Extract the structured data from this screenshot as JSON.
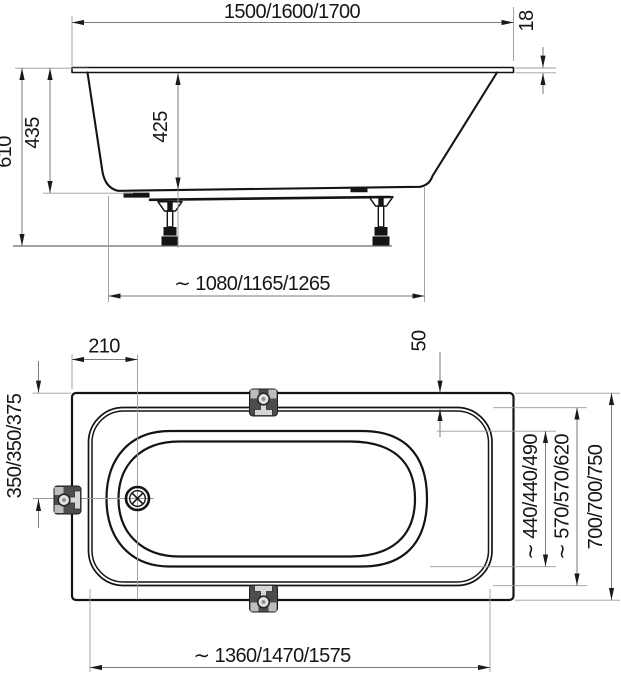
{
  "drawing": {
    "title": "bathtub-dimension-drawing",
    "side_view": {
      "length_overall": "1500/1600/1700",
      "rim_thickness": "18",
      "height_overall": "610",
      "height_body": "435",
      "depth_inner": "425",
      "base_length": "∼ 1080/1165/1265"
    },
    "top_view": {
      "drain_offset": "210",
      "rim_width": "50",
      "drain_from_edge": "350/350/375",
      "basin_width": "∼ 440/440/490",
      "inner_rim_width": "∼ 570/570/620",
      "width_overall": "700/700/750",
      "inner_rim_length": "∼ 1360/1470/1575"
    }
  }
}
